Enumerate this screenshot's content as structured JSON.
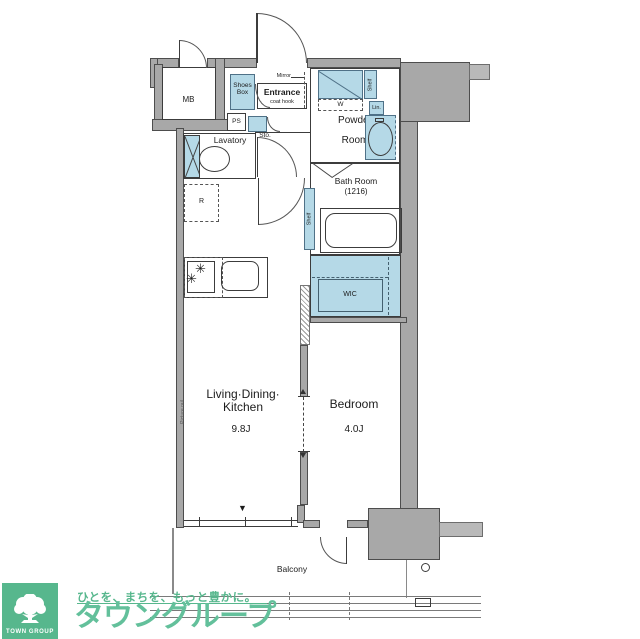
{
  "rooms": {
    "ldk": {
      "l1": "Living·Dining·",
      "l2": "Kitchen",
      "size": "9.8J"
    },
    "bedroom": {
      "name": "Bedroom",
      "size": "4.0J"
    },
    "powder": {
      "l1": "Powder",
      "l2": "Room"
    },
    "bath": {
      "name": "Bath Room",
      "size": "(1216)"
    },
    "lavatory": "Lavatory",
    "entrance": {
      "name": "Entrance",
      "coat_hook": "coat hook",
      "mirror": "Mirror"
    },
    "balcony": "Balcony",
    "wic": "WIC"
  },
  "labels": {
    "mb": "MB",
    "ps": "PS",
    "r": "R",
    "w": "W",
    "sto": "Sto.",
    "lin": "Lin.",
    "shelf": "Shelf",
    "shoes_l1": "Shoes",
    "shoes_l2": "Box",
    "picture_rail": "Picture rail"
  },
  "icons": {
    "burner": "✳",
    "window_marker": "▼"
  },
  "logo": {
    "brand": "TOWN GROUP",
    "tagline": "ひとを、まちを、もっと豊かに。",
    "brand_jp": "タウングループ"
  },
  "colors": {
    "wall_gray": "#a8a8a8",
    "fixture_blue": "#b5d9e7",
    "brand_green": "#57b78d",
    "line": "#3c3c3c"
  }
}
